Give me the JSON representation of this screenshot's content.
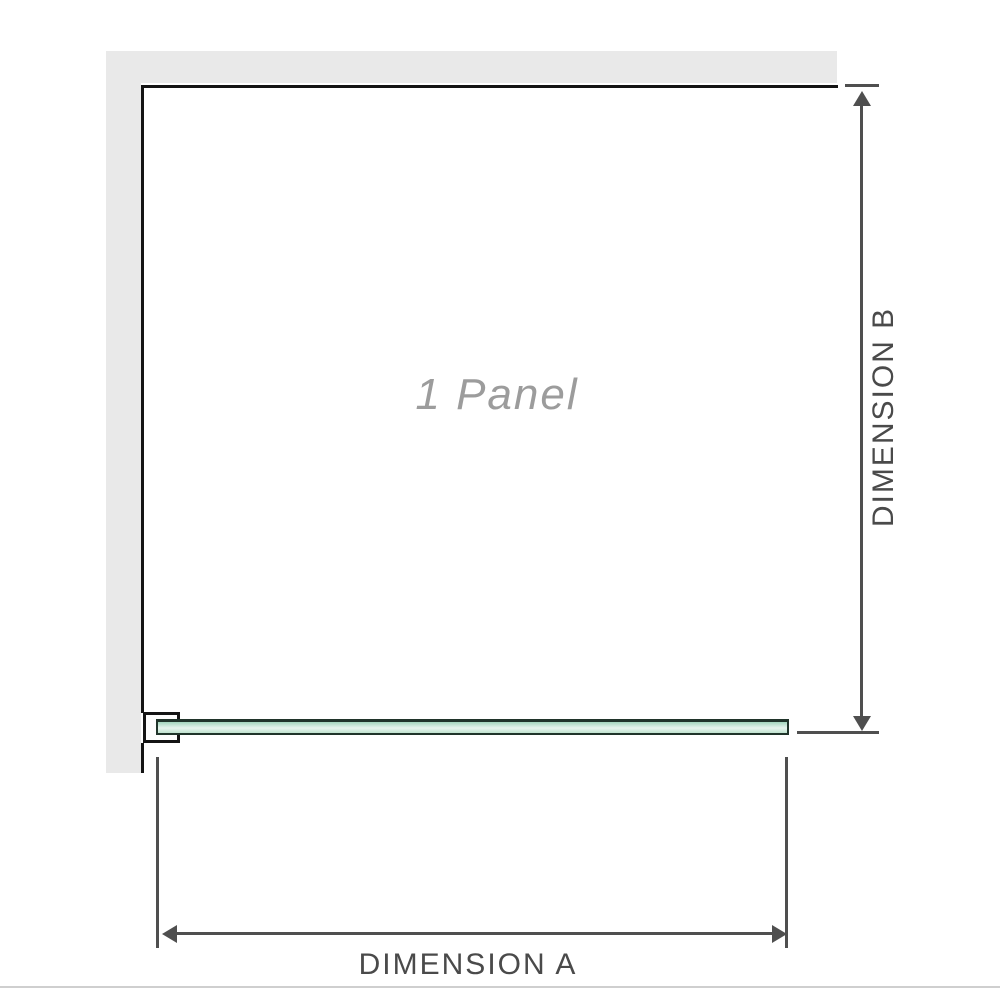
{
  "diagram": {
    "panel_label": "1 Panel",
    "dimension_a_label": "DIMENSION A",
    "dimension_b_label": "DIMENSION B"
  },
  "colors": {
    "wall": "#e9e9e9",
    "panel_outline": "#141414",
    "dimension": "#4f4f4f",
    "label_text": "#4a4a4a",
    "panel_label_text": "#9c9c9c",
    "glass_edge": "#20342a",
    "glass_fill": "#a3d5bd",
    "glass_fill_light": "#e8f5ee",
    "divider": "#cfcfcf",
    "background": "#ffffff"
  }
}
